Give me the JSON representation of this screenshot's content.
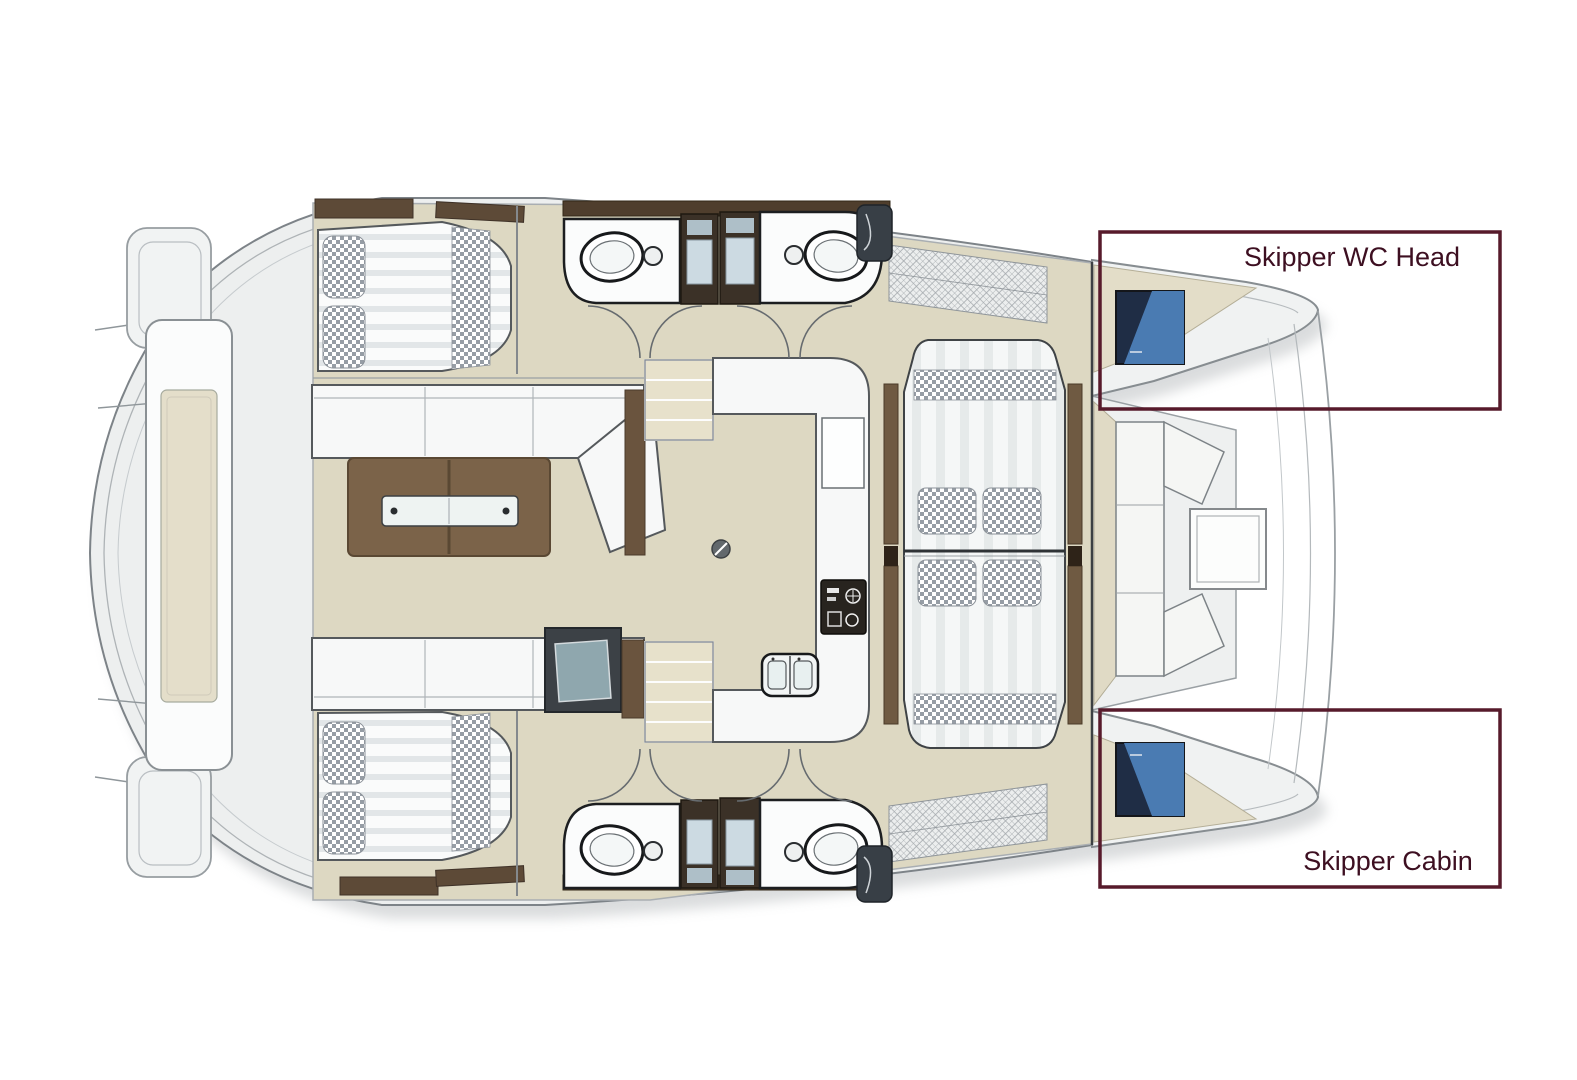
{
  "figure": {
    "kind": "catamaran-floor-plan",
    "view": "top-down deck plan, bow facing right"
  },
  "callouts": {
    "skipper_wc_head": {
      "label": "Skipper WC Head"
    },
    "skipper_cabin": {
      "label": "Skipper Cabin"
    }
  },
  "colors": {
    "background": "#ffffff",
    "deck": "#edefef",
    "interior_floor": "#ddd8c2",
    "furniture_white": "#f8f9f9",
    "wood_table": "#7b6349",
    "wood_dark_trim": "#55432f",
    "shower_dark": "#3b3127",
    "hatch_blue_dark": "#1f2d45",
    "hatch_blue_light": "#4d7fb8",
    "callout_border": "#571a2b",
    "callout_text": "#3d0f21",
    "outline_gray": "#6a7074"
  }
}
